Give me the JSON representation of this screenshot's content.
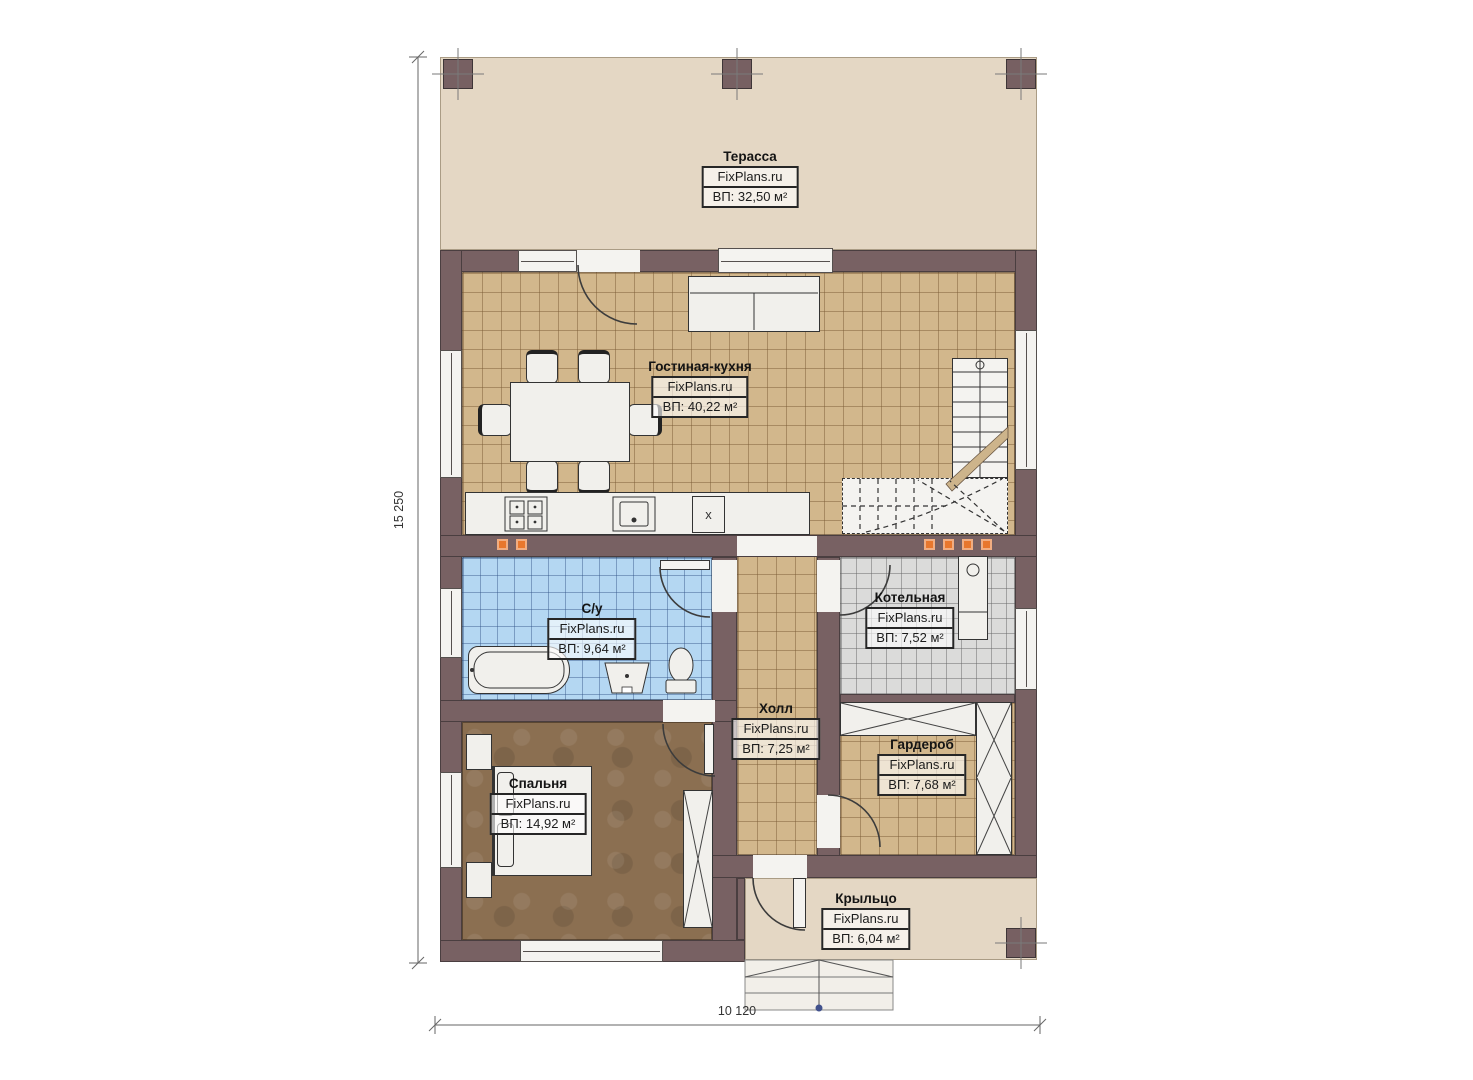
{
  "dimensions": {
    "height": "15 250",
    "width": "10 120"
  },
  "rooms": [
    {
      "name": "Терасса",
      "brand": "FixPlans.ru",
      "area": "ВП: 32,50 м²"
    },
    {
      "name": "Гостиная-кухня",
      "brand": "FixPlans.ru",
      "area": "ВП: 40,22 м²"
    },
    {
      "name": "С/у",
      "brand": "FixPlans.ru",
      "area": "ВП: 9,64 м²"
    },
    {
      "name": "Котельная",
      "brand": "FixPlans.ru",
      "area": "ВП: 7,52 м²"
    },
    {
      "name": "Холл",
      "brand": "FixPlans.ru",
      "area": "ВП: 7,25 м²"
    },
    {
      "name": "Гардероб",
      "brand": "FixPlans.ru",
      "area": "ВП: 7,68 м²"
    },
    {
      "name": "Спальня",
      "brand": "FixPlans.ru",
      "area": "ВП: 14,92 м²"
    },
    {
      "name": "Крыльцо",
      "brand": "FixPlans.ru",
      "area": "ВП: 6,04 м²"
    }
  ],
  "kitchen": {
    "x_cabinet": "x"
  },
  "colors": {
    "wall": "#786163",
    "terrace_floor": "#e4d7c4",
    "tile_tan": "#d2b78c",
    "tile_blue": "#b4d7f2",
    "tile_gray": "#dbdbda",
    "bedroom_floor": "#8b6f51",
    "accent_orange": "#e8772d"
  }
}
